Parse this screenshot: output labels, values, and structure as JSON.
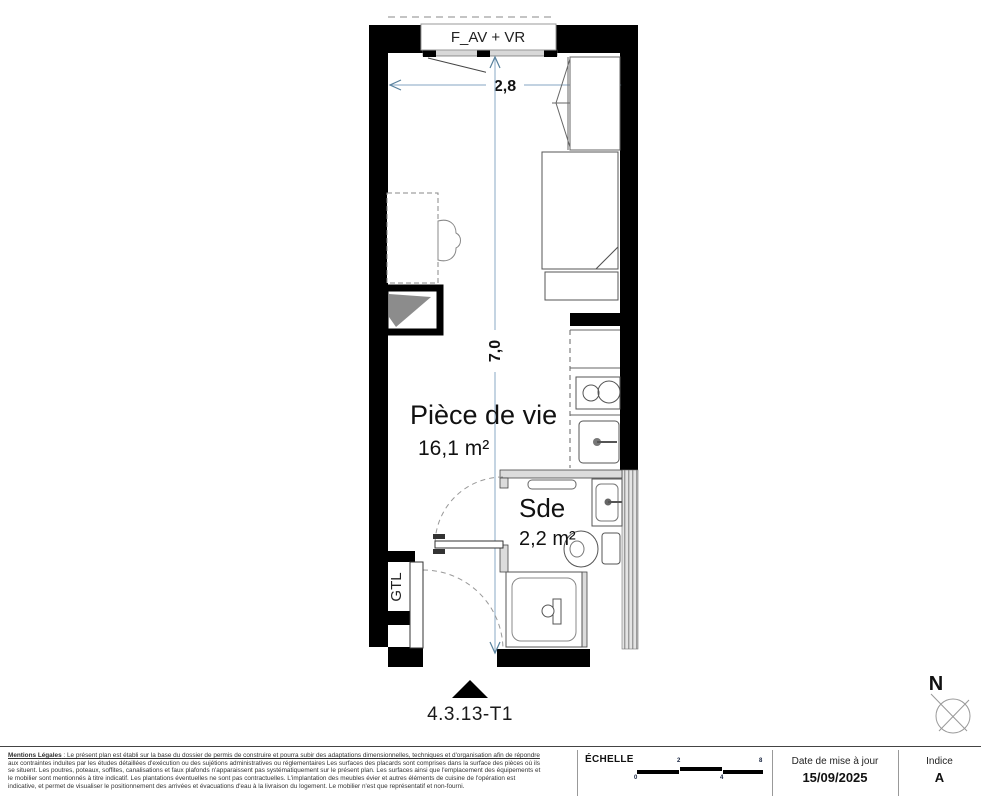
{
  "plan": {
    "window_label": "F_AV + VR",
    "dim_width": "2,8",
    "dim_height": "7,0",
    "room_main": {
      "name": "Pièce de vie",
      "area": "16,1 m²"
    },
    "room_bath": {
      "name": "Sde",
      "area": "2,2 m²"
    },
    "gtl_label": "GTL",
    "unit_label": "4.3.13-T1",
    "north_label": "N"
  },
  "footer": {
    "legal": {
      "title": "Mentions Légales",
      "title_rest": " : Le présent plan est établi sur la base du dossier de permis de construire et pourra subir des adaptations dimensionnelles, techniques et d'organisation afin de répondre",
      "lines": [
        "aux contraintes induites par les études détaillées d'exécution ou des sujétions administratives ou réglementaires Les surfaces des placards sont comprises dans la surface des pièces où ils",
        "se situent. Les poutres, poteaux, soffites, canalisations et faux plafonds n'apparaissent pas systématiquement sur le présent plan. Les surfaces ainsi que l'emplacement des équipements et",
        "le mobilier sont mentionnés à titre indicatif. Les plantations éventuelles ne sont pas contractuelles. L'implantation des meubles évier et autres éléments de cuisine de l'opération est",
        "indicative, et permet de visualiser le positionnement des arrivées et évacuations d'eau à la livraison du logement. Le mobilier n'est que représentatif et non-fourni."
      ]
    },
    "scale": {
      "label": "ÉCHELLE",
      "ticks": [
        "0",
        "2",
        "4",
        "8"
      ]
    },
    "date": {
      "label": "Date de mise à jour",
      "value": "15/09/2025"
    },
    "index": {
      "label": "Indice",
      "value": "A"
    }
  },
  "colors": {
    "wall": "#000000",
    "dimension_line": "#9db8cf",
    "thin_line": "#555555",
    "partition_fill": "#dcdcdc",
    "hatch": "#9a9a9a"
  }
}
